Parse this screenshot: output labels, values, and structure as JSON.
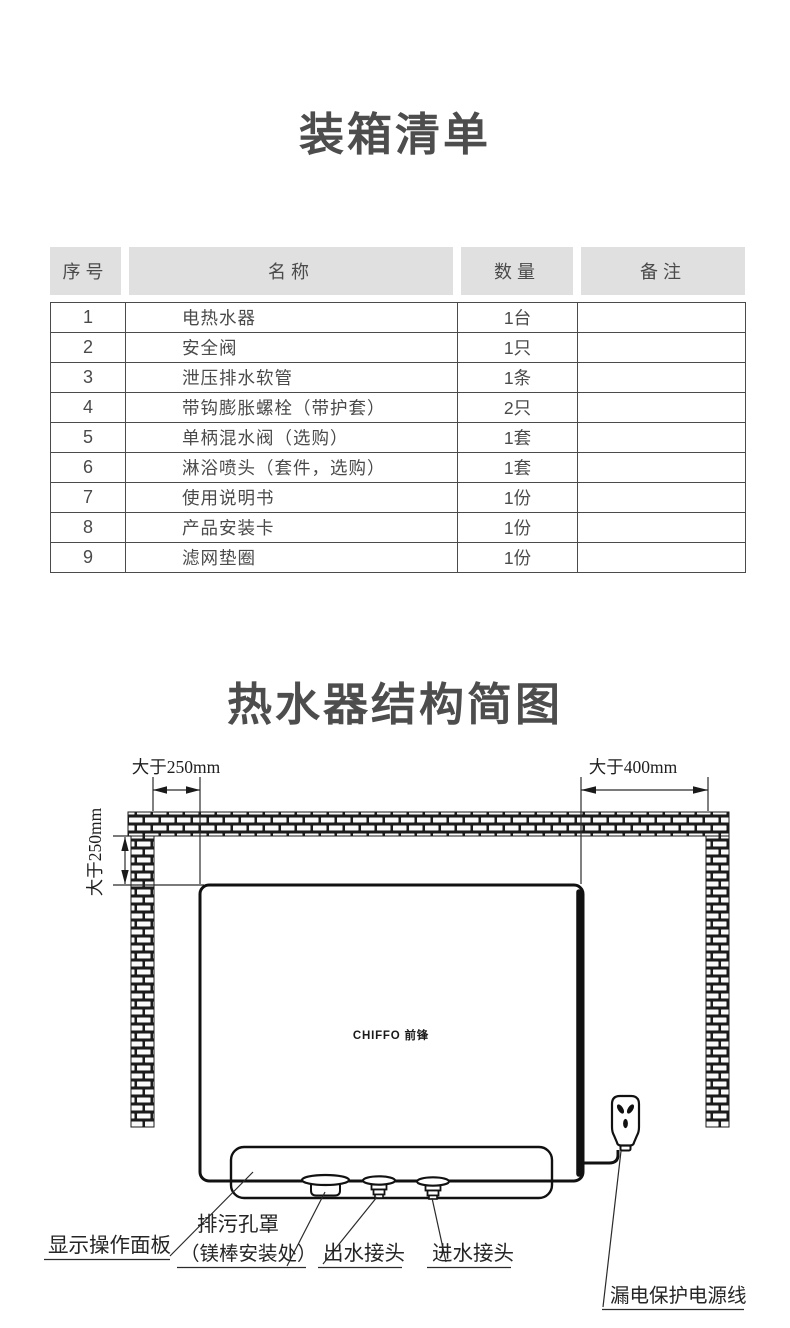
{
  "packing_list": {
    "title": "装箱清单",
    "headers": [
      "序号",
      "名称",
      "数量",
      "备注"
    ],
    "rows": [
      [
        "1",
        "电热水器",
        "1台",
        ""
      ],
      [
        "2",
        "安全阀",
        "1只",
        ""
      ],
      [
        "3",
        "泄压排水软管",
        "1条",
        ""
      ],
      [
        "4",
        "带钩膨胀螺栓（带护套）",
        "2只",
        ""
      ],
      [
        "5",
        "单柄混水阀（选购）",
        "1套",
        ""
      ],
      [
        "6",
        "淋浴喷头（套件，选购）",
        "1套",
        ""
      ],
      [
        "7",
        "使用说明书",
        "1份",
        ""
      ],
      [
        "8",
        "产品安装卡",
        "1份",
        ""
      ],
      [
        "9",
        "滤网垫圈",
        "1份",
        ""
      ]
    ]
  },
  "diagram": {
    "title": "热水器结构简图",
    "dimensions": {
      "top_left": "大于250mm",
      "top_right": "大于400mm",
      "left_side": "大于250mm"
    },
    "brand": "CHIFFO 前锋",
    "callouts": {
      "display_panel": "显示操作面板",
      "drain_cover_line1": "排污孔罩",
      "drain_cover_line2": "（镁棒安装处）",
      "water_outlet": "出水接头",
      "water_inlet": "进水接头",
      "power_cord": "漏电保护电源线"
    }
  },
  "colors": {
    "title_text": "#4d4d4d",
    "table_text": "#4a4a4a",
    "table_border": "#4b4b4b",
    "header_bg": "#e0e0e0",
    "diagram_line": "#1a1a1a",
    "background": "#ffffff"
  }
}
